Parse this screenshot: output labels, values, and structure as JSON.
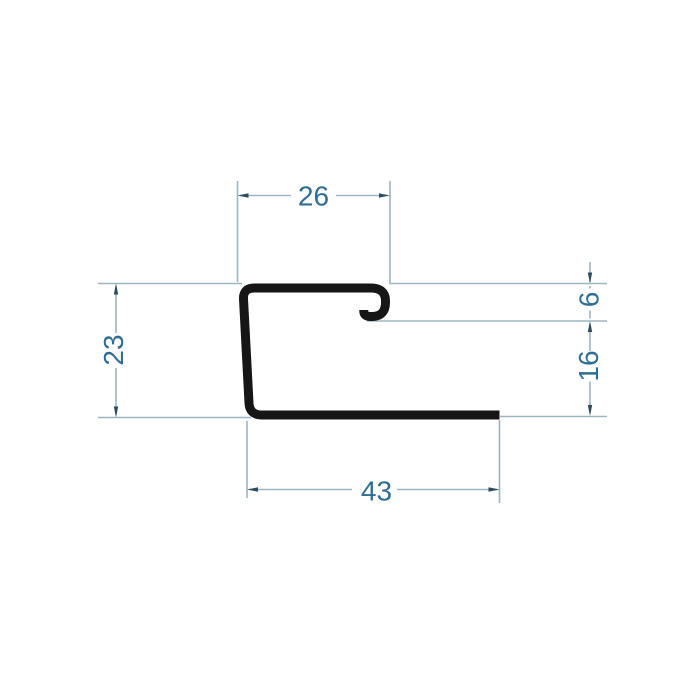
{
  "drawing": {
    "title": "profile-cross-section-dimension-drawing",
    "profile": "j-trim-hooked-profile",
    "dimensions": {
      "top_width": "26",
      "left_height": "23",
      "hook_depth": "6",
      "right_lower_height": "16",
      "bottom_width": "43"
    },
    "colors": {
      "background": "#ffffff",
      "profile_stroke": "#161616",
      "dimension_line": "#9db6c3",
      "dimension_arrow": "#2c4d5e",
      "dimension_text": "#2f6e94"
    }
  }
}
